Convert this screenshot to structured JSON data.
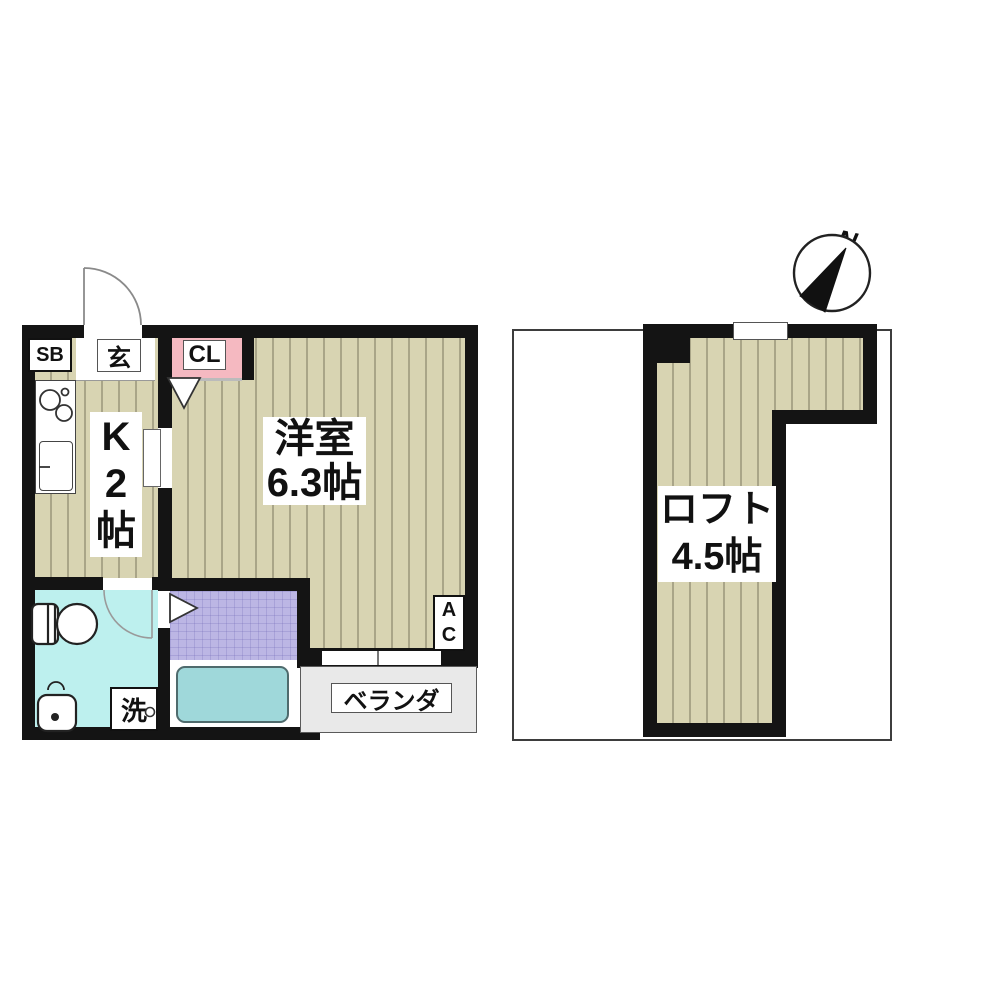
{
  "colors": {
    "wall": "#141414",
    "floor": "#d8d4b2",
    "floor-stripe": "#a9a588",
    "closet": "#f5b9c1",
    "washroom": "#bdf0ee",
    "bath": "#bcb6e4",
    "tub": "#9fd8da",
    "veranda": "#e9e9e9"
  },
  "first_floor": {
    "shoebox_label": "SB",
    "entrance_label": "玄",
    "closet_label": "CL",
    "kitchen_label": "K\n2\n帖",
    "living_room_label": "洋室\n6.3帖",
    "ac_label": "A\nC",
    "washer_label": "洗",
    "veranda_label": "ベランダ"
  },
  "loft_floor": {
    "loft_label": "ロフト\n4.5帖",
    "compass_north_label": "N"
  }
}
